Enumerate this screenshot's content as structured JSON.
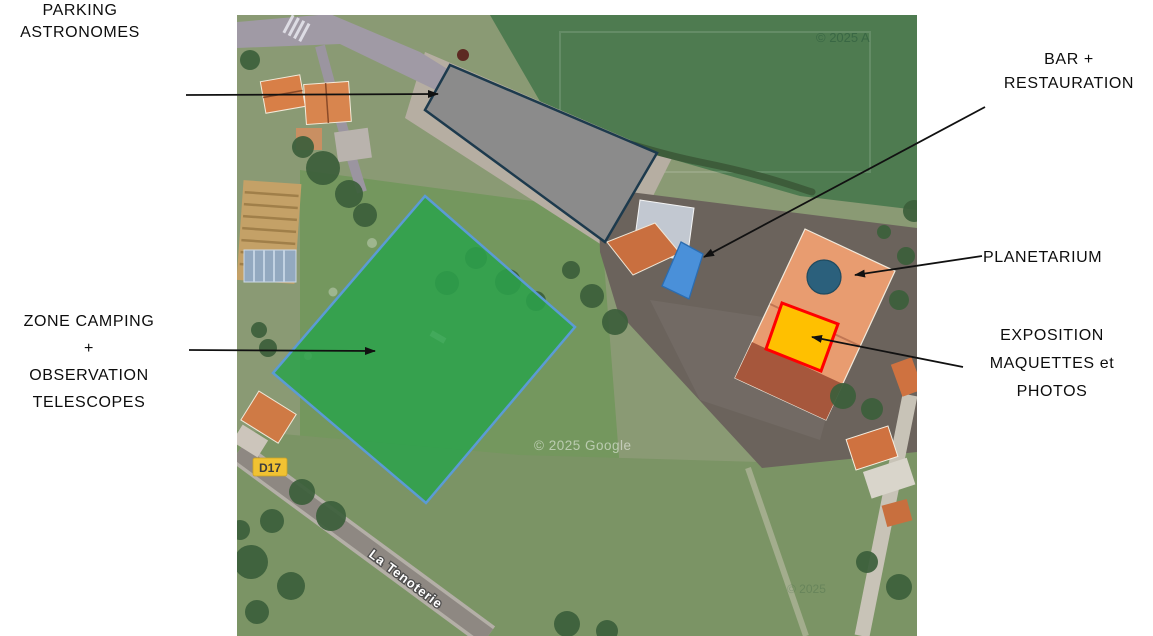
{
  "labels": {
    "parking": {
      "line1": "PARKING",
      "line2": "ASTRONOMES"
    },
    "camping": {
      "line1": "ZONE CAMPING",
      "line2": "+",
      "line3": "OBSERVATION",
      "line4": "TELESCOPES"
    },
    "bar": {
      "line1": "BAR +",
      "line2": "RESTAURATION"
    },
    "planetarium": {
      "line1": "PLANETARIUM"
    },
    "exposition": {
      "line1": "EXPOSITION",
      "line2": "MAQUETTES et",
      "line3": "PHOTOS"
    }
  },
  "map": {
    "road_badge": "D17",
    "road_name": "La Tenoterie",
    "watermark_center": "© 2025 Google",
    "watermark_top_right": "© 2025 A",
    "watermark_bottom_right": "© 2025"
  },
  "zones": {
    "parking": {
      "fill": "#8b8b8b",
      "stroke": "#1d3a4d"
    },
    "camping": {
      "fill": "#2ca24b",
      "stroke": "#5b9bd5"
    },
    "bar": {
      "fill": "#4a90d9",
      "stroke": "#2b6cb0"
    },
    "planetarium": {
      "fill": "#2b607c",
      "stroke": "#1f4a5f"
    },
    "exposition": {
      "fill": "#ffc000",
      "stroke": "#ff0000"
    }
  },
  "arrow_color": "#111111"
}
